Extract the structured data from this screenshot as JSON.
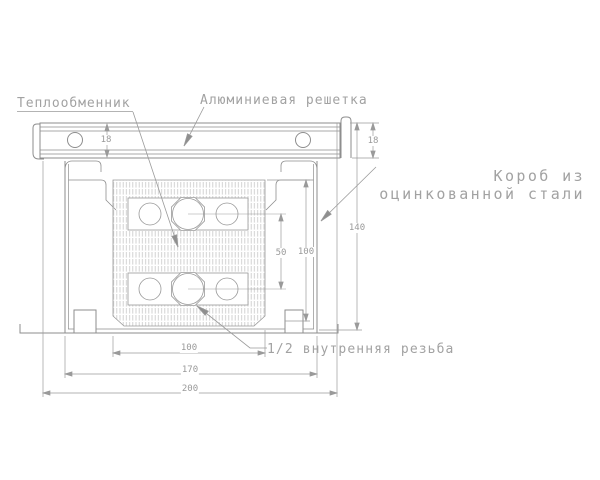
{
  "title": "Конвектор — чертёж поперечного сечения",
  "labels": {
    "heat_exchanger": "Теплообменник",
    "grille": "Алюминиевая решетка",
    "box_line1": "Короб из",
    "box_line2": "оцинкованной стали",
    "thread": "1/2 внутренняя резьба"
  },
  "dimensions": {
    "grille_height_left": "18",
    "grille_height_right": "18",
    "box_height": "140",
    "core_height": "100",
    "pipe_spacing": "50",
    "core_width": "100",
    "box_width": "170",
    "overall_width": "200"
  },
  "colors": {
    "background": "#ffffff",
    "line": "#8e8e8e",
    "text": "#a2a2a2",
    "dim_text": "#9a9a9a",
    "hatch": "#cccccc"
  }
}
